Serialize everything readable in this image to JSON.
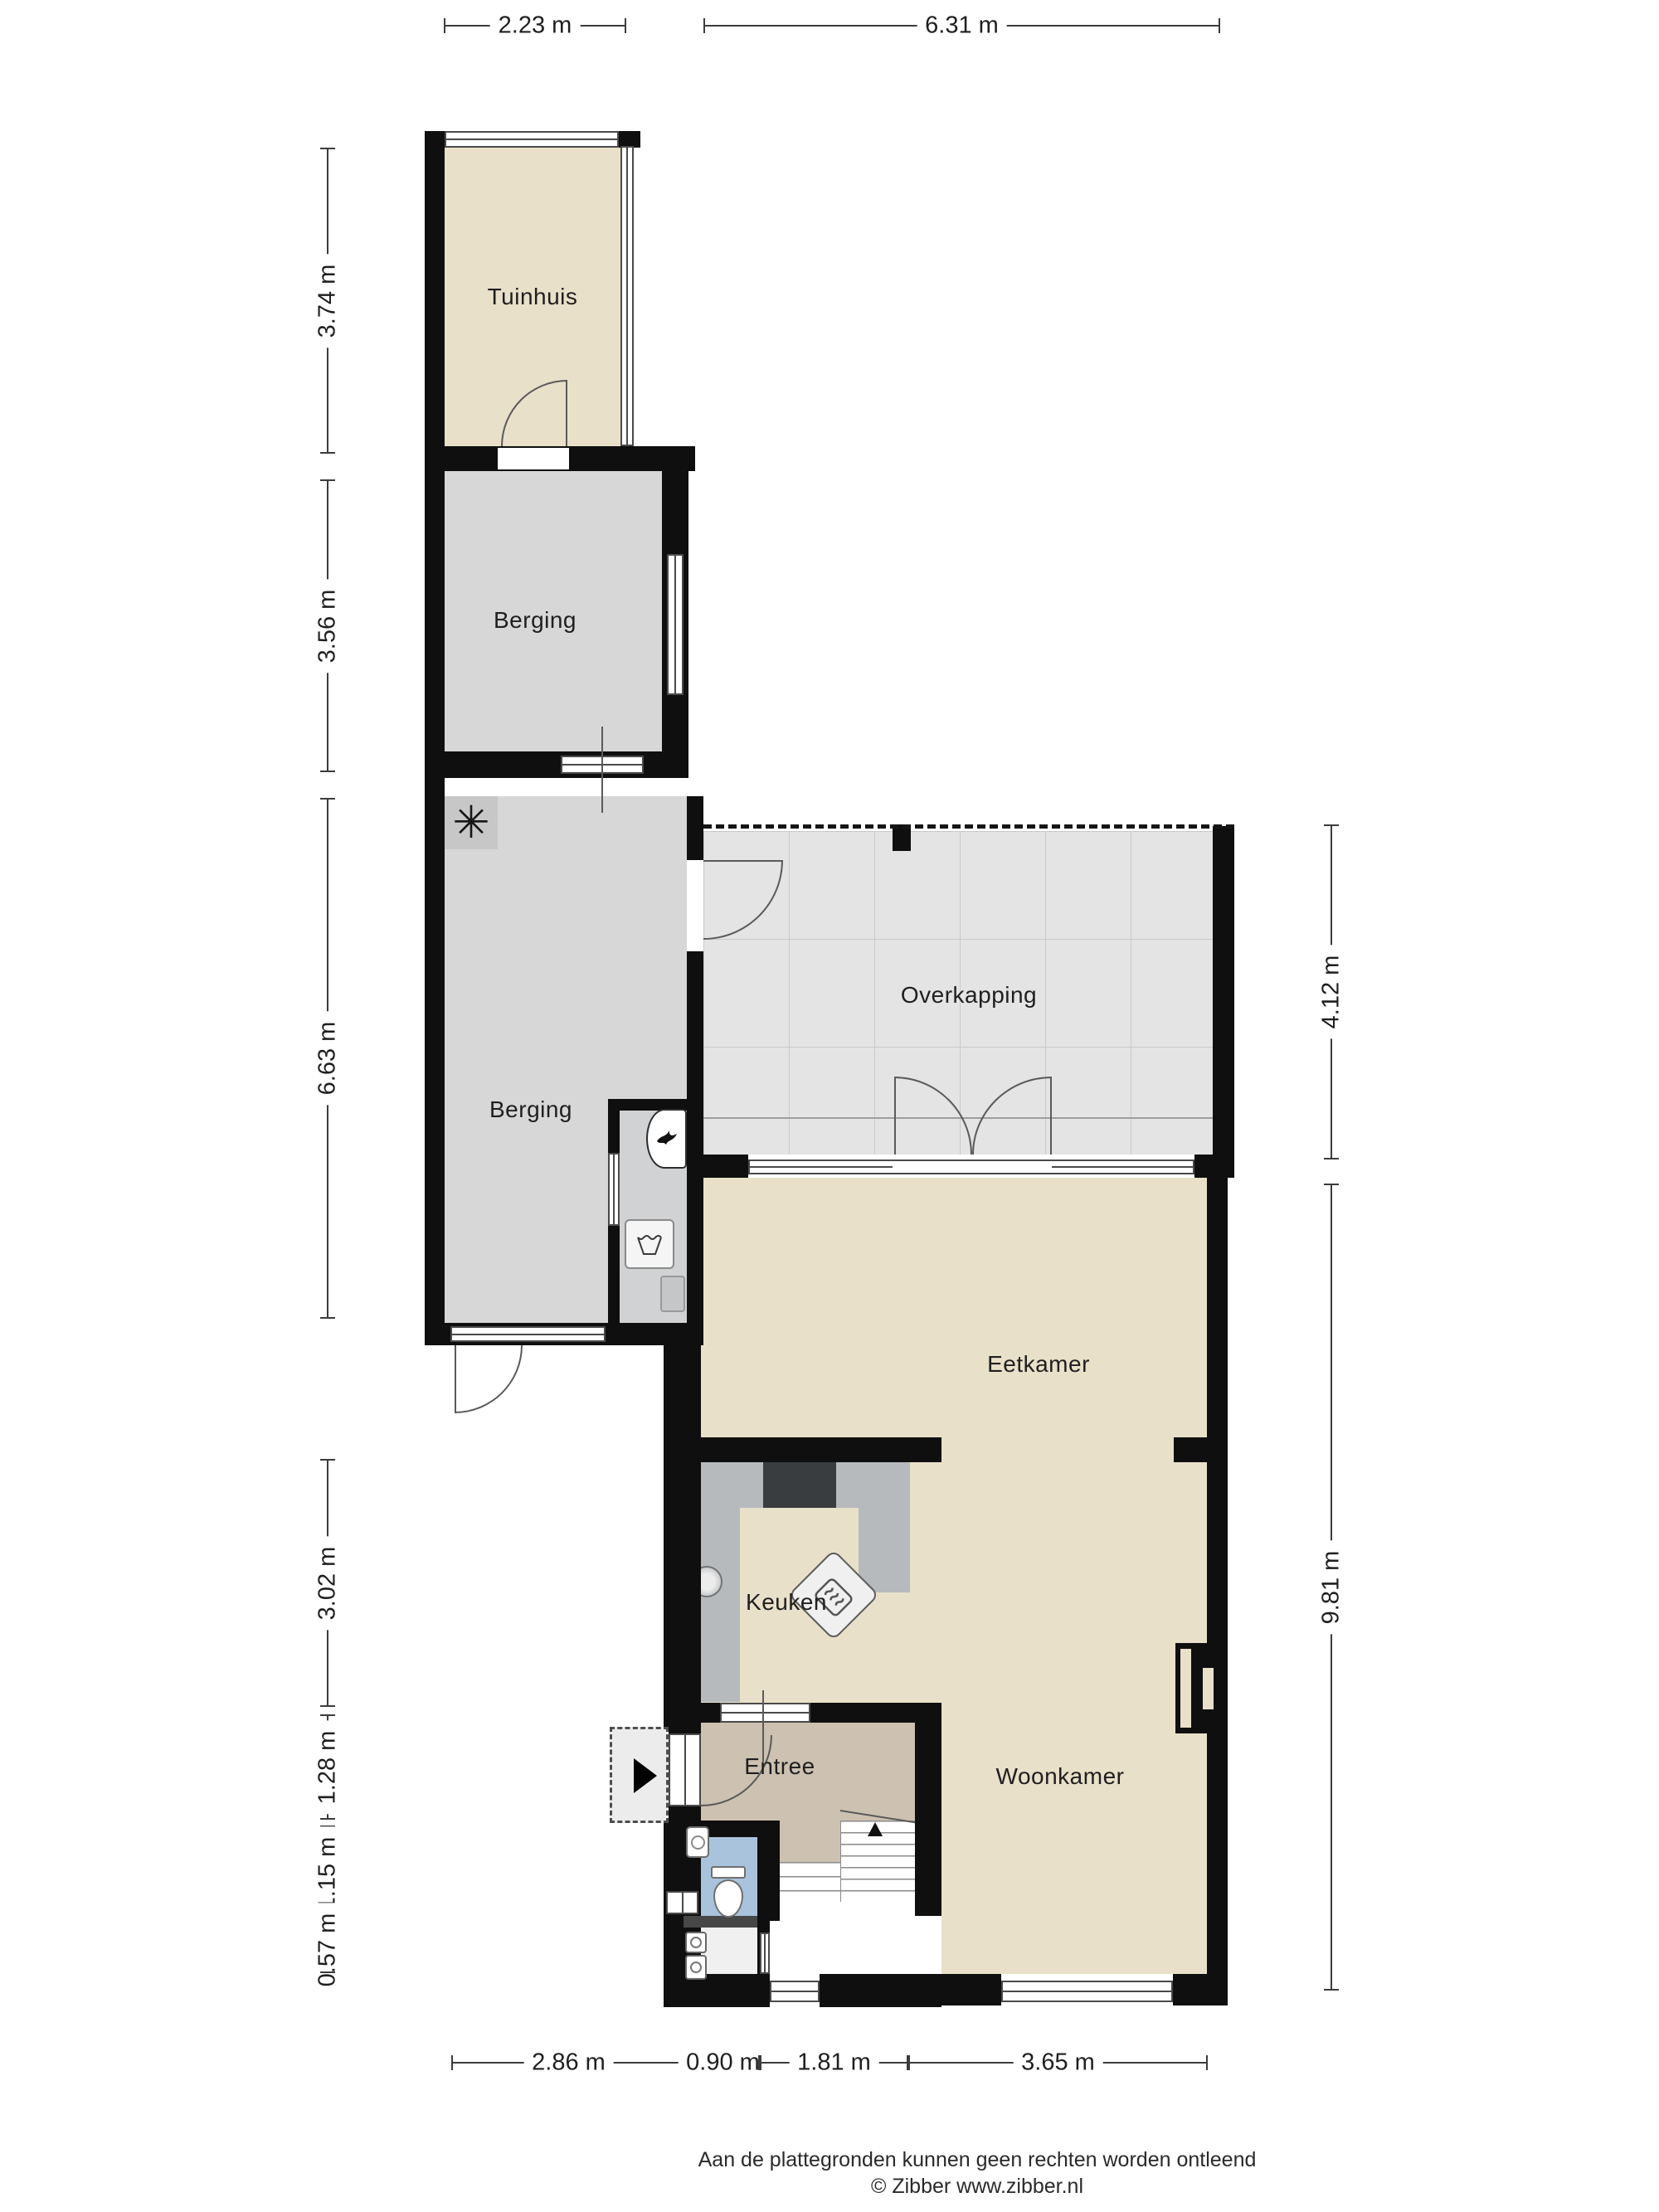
{
  "plan": {
    "rooms": [
      {
        "id": "tuinhuis",
        "label": "Tuinhuis"
      },
      {
        "id": "berging-boven",
        "label": "Berging"
      },
      {
        "id": "berging",
        "label": "Berging"
      },
      {
        "id": "overkapping",
        "label": "Overkapping"
      },
      {
        "id": "eetkamer",
        "label": "Eetkamer"
      },
      {
        "id": "keuken",
        "label": "Keuken"
      },
      {
        "id": "entree",
        "label": "Entree"
      },
      {
        "id": "woonkamer",
        "label": "Woonkamer"
      }
    ]
  },
  "dimensions": {
    "top": [
      {
        "label": "2.23 m"
      },
      {
        "label": "6.31 m"
      }
    ],
    "left": [
      {
        "label": "3.74 m"
      },
      {
        "label": "3.56 m"
      },
      {
        "label": "6.63 m"
      },
      {
        "label": "3.02 m"
      },
      {
        "label": "1.28 m"
      },
      {
        "label": "1.15 m"
      },
      {
        "label": "0.57 m"
      }
    ],
    "right": [
      {
        "label": "4.12 m"
      },
      {
        "label": "9.81 m"
      }
    ],
    "bottom": [
      {
        "label": "2.86 m"
      },
      {
        "label": "0.90 m"
      },
      {
        "label": "1.81 m"
      },
      {
        "label": "3.65 m"
      }
    ]
  },
  "footer": {
    "disclaimer": "Aan de plattegronden kunnen geen rechten worden ontleend",
    "copyright": "© Zibber www.zibber.nl"
  },
  "fixtures": {
    "fan_glyph": "✳"
  },
  "colors": {
    "wall": "#0f0f0f",
    "cream": "#e8e0c9",
    "gray": "#d7d7d7",
    "gray2": "#d0d2d4",
    "overkap": "#e4e4e4",
    "taupe": "#cdc1b1",
    "blue": "#aac3dc",
    "counter": "#b6babd",
    "stove": "#3a3d40",
    "line": "#4a4a4a",
    "dim": "#3c3c3c",
    "text": "#1f1f1f",
    "paper": "#ffffff"
  }
}
